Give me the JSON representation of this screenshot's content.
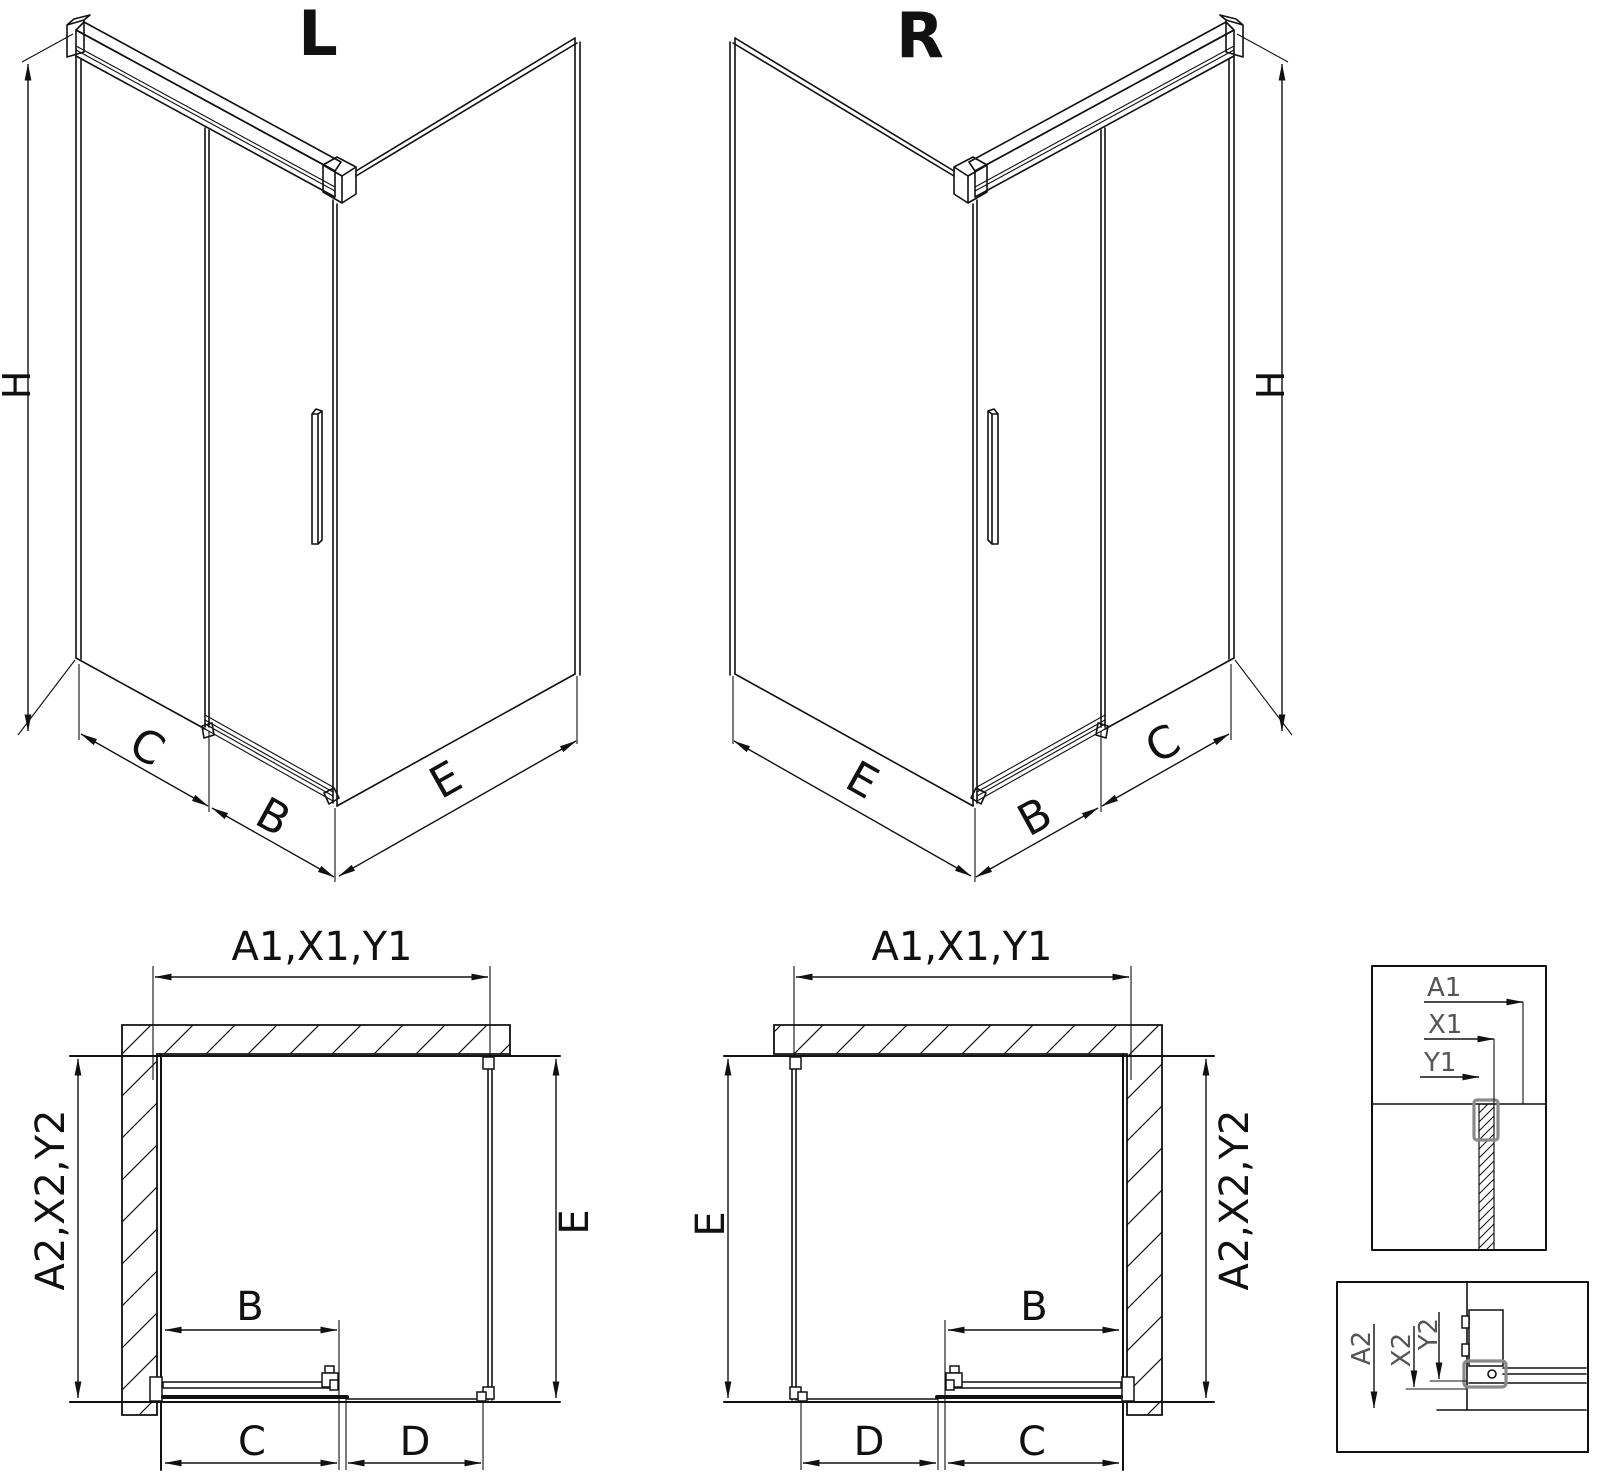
{
  "iso_left": {
    "title": "L",
    "dims": {
      "h": "H",
      "c": "C",
      "b": "B",
      "e": "E"
    }
  },
  "iso_right": {
    "title": "R",
    "dims": {
      "h": "H",
      "c": "C",
      "b": "B",
      "e": "E"
    }
  },
  "plan_left": {
    "dims": {
      "top": "A1,X1,Y1",
      "side": "A2,X2,Y2",
      "e": "E",
      "b": "B",
      "c": "C",
      "d": "D"
    }
  },
  "plan_right": {
    "dims": {
      "top": "A1,X1,Y1",
      "side": "A2,X2,Y2",
      "e": "E",
      "b": "B",
      "c": "C",
      "d": "D"
    }
  },
  "detail_top": {
    "dims": {
      "a1": "A1",
      "x1": "X1",
      "y1": "Y1"
    }
  },
  "detail_bottom": {
    "dims": {
      "a2": "A2",
      "x2": "X2",
      "y2": "Y2"
    }
  },
  "colors": {
    "line": "#111111",
    "detail_label": "#555555",
    "profile": "#8a8a8a",
    "background": "#ffffff"
  }
}
